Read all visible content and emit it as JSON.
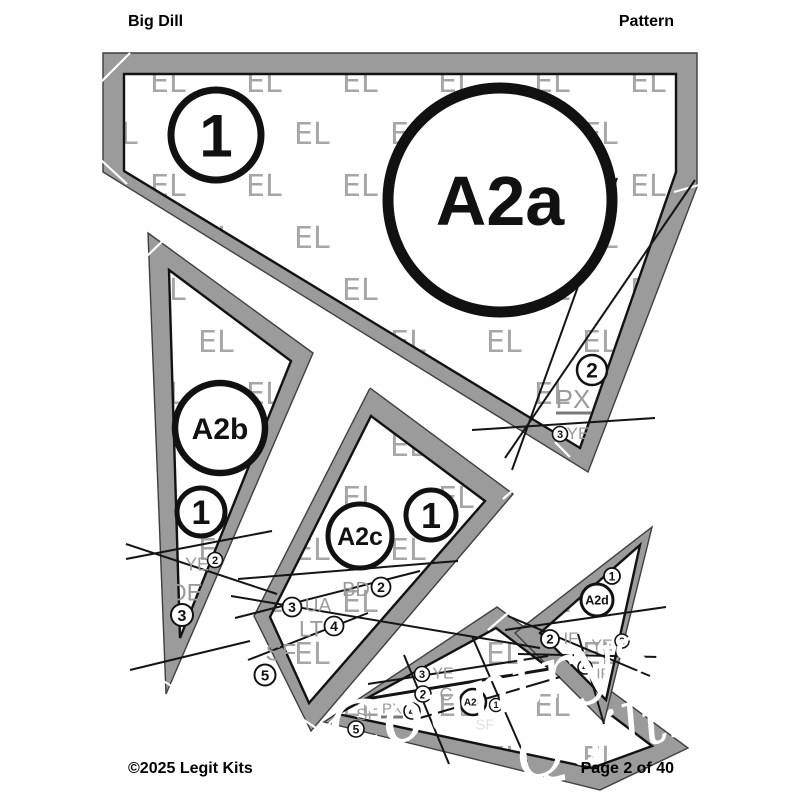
{
  "header": {
    "title": "Big Dill",
    "doc_type": "Pattern"
  },
  "footer": {
    "copyright": "©2025 Legit Kits",
    "page": "Page 2 of 40"
  },
  "watermark": {
    "tile_text": "EL",
    "script_line1": "Countryside",
    "script_line2": "Quilts"
  },
  "colors": {
    "band": "#9b9b9b",
    "band_edge": "#3f3f3f",
    "seam_line": "#141414",
    "el_gray": "#a6a6a6",
    "code_gray": "#9a9a9a",
    "code_light": "#e3e3e3",
    "black": "#111111",
    "white": "#ffffff",
    "underline_gray": "#787878"
  },
  "piece_badges": [
    {
      "label": "A2a",
      "x": 500,
      "y": 200,
      "r": 112,
      "sw": 11,
      "fs": 70
    },
    {
      "label": "A2b",
      "x": 220,
      "y": 428,
      "r": 45,
      "sw": 6.5,
      "fs": 30
    },
    {
      "label": "A2c",
      "x": 360,
      "y": 536,
      "r": 32,
      "sw": 5,
      "fs": 25
    },
    {
      "label": "A2d",
      "x": 597,
      "y": 600,
      "r": 16,
      "sw": 3,
      "fs": 12.5
    },
    {
      "label": "A2e",
      "x": 473,
      "y": 702,
      "r": 13,
      "sw": 2.5,
      "fs": 10
    }
  ],
  "step_circles": [
    {
      "n": "1",
      "x": 216,
      "y": 135,
      "r": 45,
      "sw": 7,
      "fs": 60
    },
    {
      "n": "2",
      "x": 592,
      "y": 370,
      "r": 15,
      "sw": 2.5,
      "fs": 21
    },
    {
      "n": "3",
      "x": 560,
      "y": 434,
      "r": 7.5,
      "sw": 1.6,
      "fs": 11
    },
    {
      "n": "1",
      "x": 201,
      "y": 512,
      "r": 24,
      "sw": 5,
      "fs": 34
    },
    {
      "n": "2",
      "x": 215,
      "y": 560,
      "r": 7.5,
      "sw": 1.6,
      "fs": 11
    },
    {
      "n": "3",
      "x": 182,
      "y": 615,
      "r": 11,
      "sw": 2,
      "fs": 16
    },
    {
      "n": "1",
      "x": 431,
      "y": 515,
      "r": 25,
      "sw": 5,
      "fs": 36
    },
    {
      "n": "2",
      "x": 381,
      "y": 587,
      "r": 9.5,
      "sw": 1.8,
      "fs": 14
    },
    {
      "n": "3",
      "x": 292,
      "y": 607,
      "r": 9.5,
      "sw": 1.8,
      "fs": 14
    },
    {
      "n": "4",
      "x": 334,
      "y": 626,
      "r": 9.5,
      "sw": 1.8,
      "fs": 14
    },
    {
      "n": "5",
      "x": 265,
      "y": 675,
      "r": 10.5,
      "sw": 2,
      "fs": 15
    },
    {
      "n": "3",
      "x": 422,
      "y": 674,
      "r": 7.5,
      "sw": 1.6,
      "fs": 11
    },
    {
      "n": "2",
      "x": 423,
      "y": 694,
      "r": 8,
      "sw": 1.6,
      "fs": 12
    },
    {
      "n": "4",
      "x": 412,
      "y": 711,
      "r": 8,
      "sw": 1.6,
      "fs": 12
    },
    {
      "n": "5",
      "x": 356,
      "y": 729,
      "r": 8,
      "sw": 1.6,
      "fs": 12
    },
    {
      "n": "1",
      "x": 496,
      "y": 705,
      "r": 6.5,
      "sw": 1.4,
      "fs": 9
    },
    {
      "n": "1",
      "x": 612,
      "y": 576,
      "r": 8,
      "sw": 1.8,
      "fs": 12
    },
    {
      "n": "2",
      "x": 550,
      "y": 639,
      "r": 9,
      "sw": 1.8,
      "fs": 13
    },
    {
      "n": "3",
      "x": 622,
      "y": 641,
      "r": 7,
      "sw": 1.5,
      "fs": 10
    },
    {
      "n": "4",
      "x": 585,
      "y": 667,
      "r": 7,
      "sw": 1.5,
      "fs": 10
    }
  ],
  "code_labels": [
    {
      "t": "PX",
      "x": 573,
      "y": 399,
      "fs": 26,
      "ul": [
        556,
        413,
        591
      ]
    },
    {
      "t": "YE",
      "x": 578,
      "y": 433,
      "fs": 17
    },
    {
      "t": "YE",
      "x": 197,
      "y": 564,
      "fs": 18
    },
    {
      "t": "DE",
      "x": 186,
      "y": 592,
      "fs": 24
    },
    {
      "t": "BD",
      "x": 356,
      "y": 589,
      "fs": 20
    },
    {
      "t": "UA",
      "x": 318,
      "y": 605,
      "fs": 19
    },
    {
      "t": "LT",
      "x": 311,
      "y": 629,
      "fs": 22
    },
    {
      "t": "SF",
      "x": 281,
      "y": 652,
      "fs": 24
    },
    {
      "t": "YE",
      "x": 443,
      "y": 673,
      "fs": 16
    },
    {
      "t": "C",
      "x": 446,
      "y": 694,
      "fs": 18
    },
    {
      "t": "SF",
      "x": 367,
      "y": 714,
      "fs": 17
    },
    {
      "t": "PX",
      "x": 392,
      "y": 708,
      "fs": 15,
      "ul": [
        381,
        717,
        403
      ]
    },
    {
      "t": "SF",
      "x": 485,
      "y": 724,
      "fs": 15,
      "light": true
    },
    {
      "t": "IF",
      "x": 571,
      "y": 638,
      "fs": 17
    },
    {
      "t": "YE",
      "x": 602,
      "y": 645,
      "fs": 16
    },
    {
      "t": "IF",
      "x": 603,
      "y": 673,
      "fs": 15
    }
  ]
}
